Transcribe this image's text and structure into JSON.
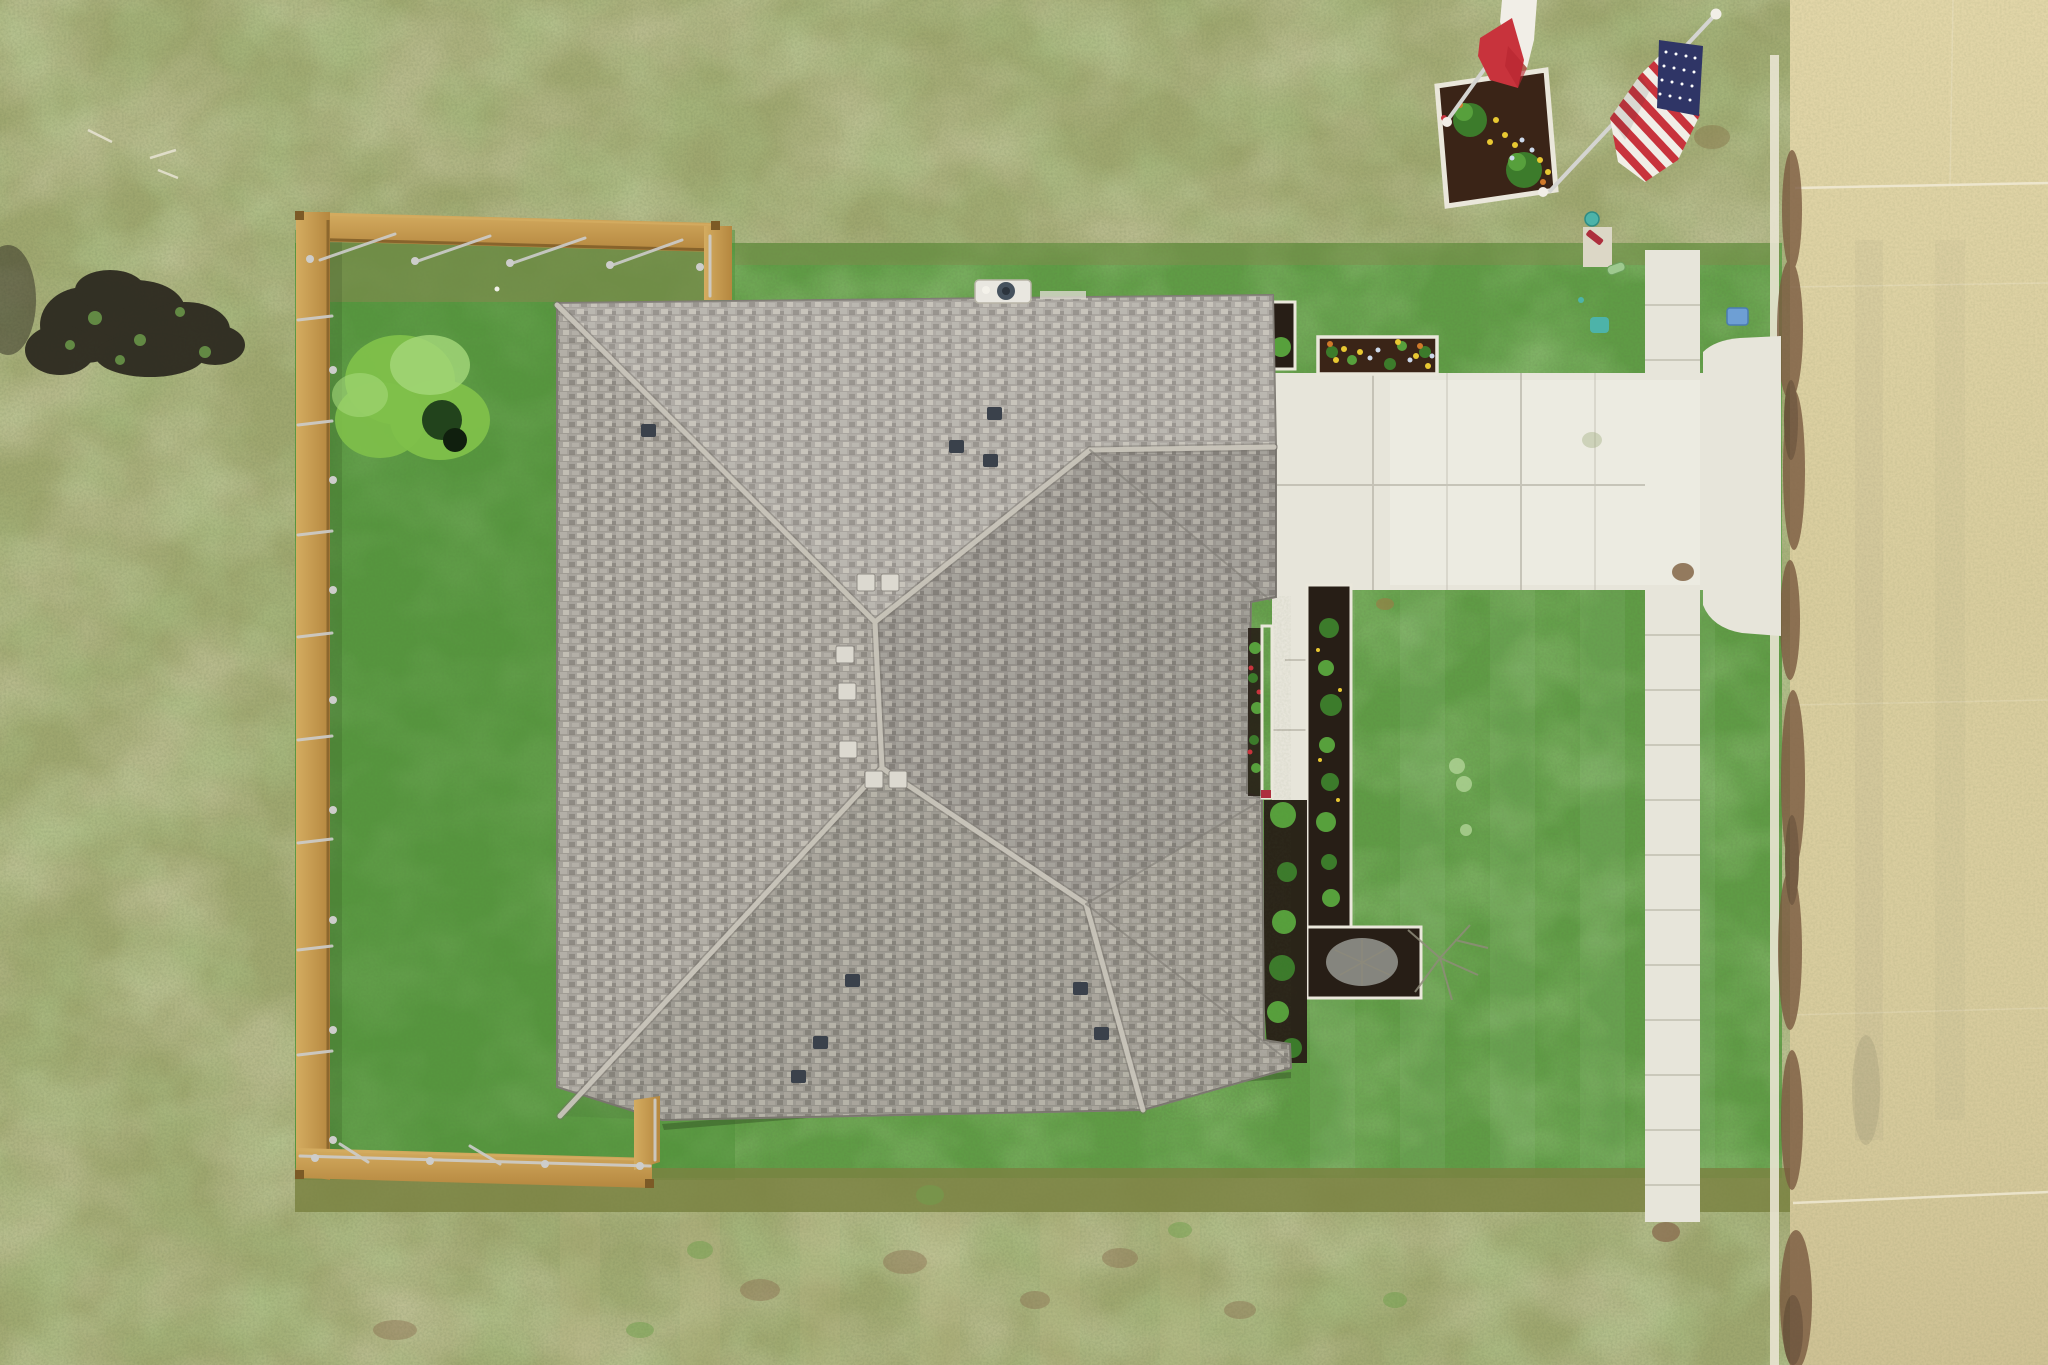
{
  "scene": {
    "type": "aerial-drone-photo",
    "description": "Top-down aerial photo of a single-family home with a gray shingled hip roof, a wood-fenced backyard on the left with one bright green shrub, front flower beds with dark mulch, a white concrete walkway and sidewalk leading to a tan street on the right, and a corner flower planter flying a Texas flag and an American flag.",
    "objects": [
      "hip-roof-house",
      "roof-vents",
      "ridge-vents",
      "chimney-fan",
      "wood-privacy-fence",
      "backyard-lawn",
      "bright-green-shrub",
      "front-lawn",
      "flower-planter",
      "front-flower-beds",
      "porch-railing",
      "dead-shrub",
      "concrete-walkway",
      "sidewalk",
      "driveway-apron",
      "street",
      "curb",
      "dirt-road-edge",
      "texas-flag",
      "american-flag",
      "flag-planter",
      "utility-markers",
      "concrete-pad",
      "dirt-patch",
      "field-grass"
    ]
  },
  "palette": {
    "fieldBase": "#9FA76F",
    "fieldTan": "#C2B985",
    "fieldGreen": "#74A04E",
    "lawn": "#5F9C45",
    "lawnLight": "#7AB158",
    "lawnDark": "#4A8637",
    "backyardTint": "#4E9038",
    "oliveTop": "#82894E",
    "oliveBand": "#7A8342",
    "roofBase": "#A7A39C",
    "roofLight": "#C2BEB4",
    "roofMid": "#B3AFA7",
    "roofDark": "#8E8A83",
    "roofEdge": "#7F7B74",
    "roofCap": "#C9C5BA",
    "roofCapShadow": "#75716A",
    "ventDark": "#3A414B",
    "ventWhite": "#DCD9D0",
    "chimneyWhite": "#E9E7E0",
    "fanBlue": "#46525E",
    "concrete": "#E7E5DA",
    "concreteBright": "#F2F1E9",
    "concreteJoint": "#B7B4A6",
    "padConcrete": "#DCD7C6",
    "road": "#D9CD9E",
    "roadLight": "#E9DDB0",
    "roadDark": "#C2B488",
    "roadJoint": "#F0E9D2",
    "curb": "#E9E4D2",
    "dirtEdge": "#7A5A40",
    "dirtEdgeDark": "#5E422F",
    "mudBrown": "#8A6E50",
    "woodLight": "#D4AC60",
    "woodMid": "#B5873F",
    "woodDark": "#7C5A26",
    "railSilver": "#CDCDCB",
    "mulch": "#271E16",
    "mulchRed": "#3A2417",
    "bedBorder": "#EAE7DB",
    "shrub": "#3C7B2B",
    "shrubLight": "#57A03C",
    "bushBright": "#7FC04A",
    "bushBrightLight": "#A5D87A",
    "bushCenterDark": "#22431C",
    "deadBush": "#90908A",
    "branchGray": "#8F8C7A",
    "flagRed": "#C8333C",
    "flagWhite": "#F1EEE7",
    "flagBlue": "#2F3566",
    "poleSilver": "#D4D4D1",
    "tealMarker": "#4DB3A9",
    "blueBox": "#6E9FD4",
    "capsuleGreen": "#9EC98F",
    "redItem": "#AD2F3D",
    "flowerYellow": "#E8C832",
    "flowerOrange": "#D07A2A",
    "flowerBlue": "#CCD8EA",
    "sprinkler": "#B6D79B",
    "dirtBlack": "#2D2A20",
    "weedGreen": "#6FA04C",
    "stickWhite": "#E8E4D4",
    "shadow": "#1F2C15"
  }
}
